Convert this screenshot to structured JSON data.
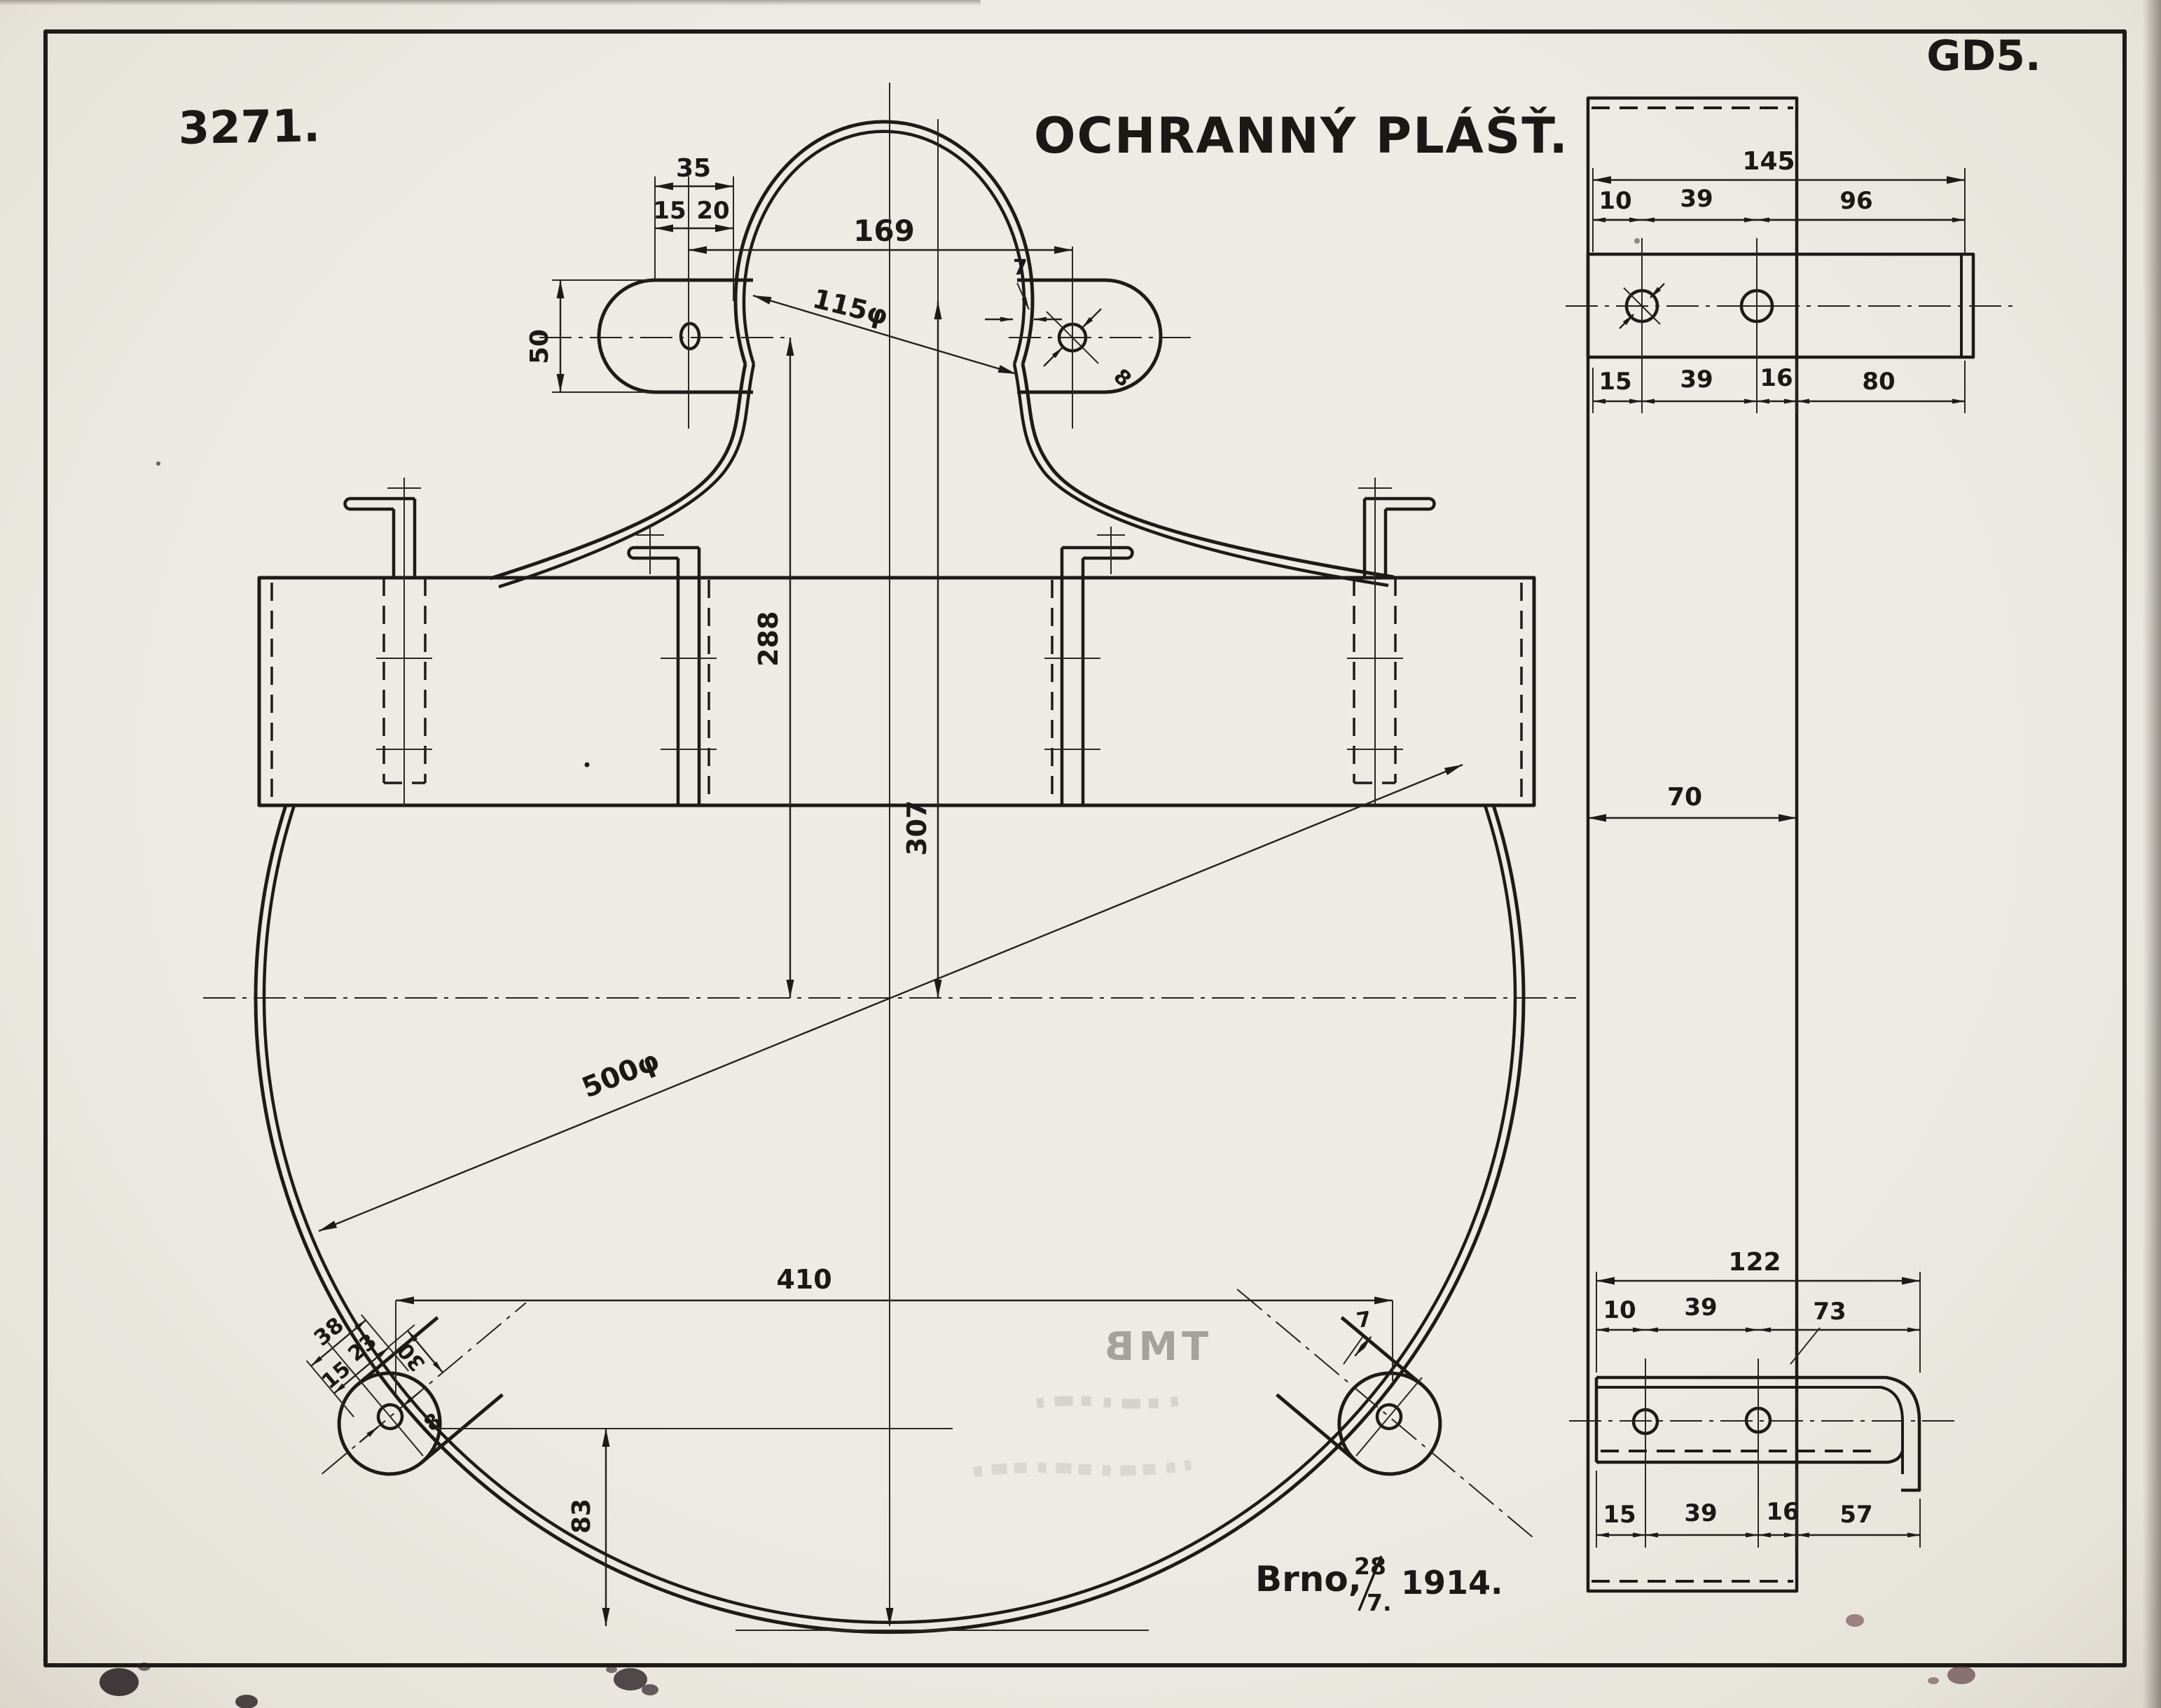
{
  "sheet": {
    "drawing_number": "3271.",
    "title": "OCHRANNÝ PLÁŠŤ.",
    "sheet_code": "GD5.",
    "issued": {
      "city": "Brno,",
      "day": "28",
      "month": "7.",
      "year": "1914."
    },
    "stamp": {
      "text": "TMB"
    }
  },
  "front_view": {
    "bracket_dims": {
      "width": "35",
      "left": "15",
      "right": "20",
      "height": "50"
    },
    "dome": {
      "span": "169",
      "diameter": "115φ",
      "wall": "7",
      "hole": "8"
    },
    "heights": {
      "band_to_center": "288",
      "dome_to_center": "307"
    },
    "disc": {
      "diameter": "500φ",
      "lug_span": "410",
      "lug_height": "83"
    },
    "bottom_left_lug": {
      "overall": "38",
      "left": "15",
      "right": "23",
      "depth": "30",
      "hole": "8"
    },
    "bottom_right_lug": {
      "wall": "7"
    }
  },
  "side_strip": {
    "width": "70"
  },
  "detail_top": {
    "overall": "145",
    "top": [
      "10",
      "39",
      "96"
    ],
    "bottom": [
      "15",
      "39",
      "16",
      "80"
    ]
  },
  "detail_bottom": {
    "overall": "122",
    "top": [
      "10",
      "39",
      "73"
    ],
    "bottom": [
      "15",
      "39",
      "16",
      "57"
    ]
  }
}
